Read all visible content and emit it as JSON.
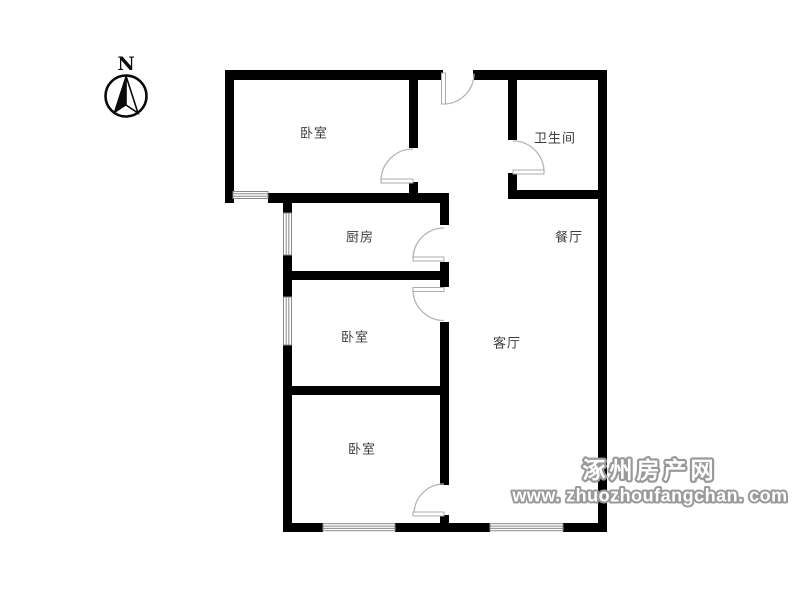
{
  "compass": {
    "label": "N"
  },
  "rooms": [
    {
      "id": "bedroom-top-left",
      "label": "卧室"
    },
    {
      "id": "bathroom",
      "label": "卫生间"
    },
    {
      "id": "kitchen",
      "label": "厨房"
    },
    {
      "id": "dining-room",
      "label": "餐厅"
    },
    {
      "id": "bedroom-middle",
      "label": "卧室"
    },
    {
      "id": "living-room",
      "label": "客厅"
    },
    {
      "id": "bedroom-bottom",
      "label": "卧室"
    }
  ],
  "watermark": {
    "site_name": "涿州房产网",
    "site_url": "www. zhuozhoufangchan. com"
  },
  "colors": {
    "wall": "#000000",
    "door": "#b5b5b5",
    "window": "#8a8a8a",
    "room_label": "#3d3d3d",
    "watermark_outline": "#9a9a9a",
    "watermark_fill": "#ffffff"
  }
}
